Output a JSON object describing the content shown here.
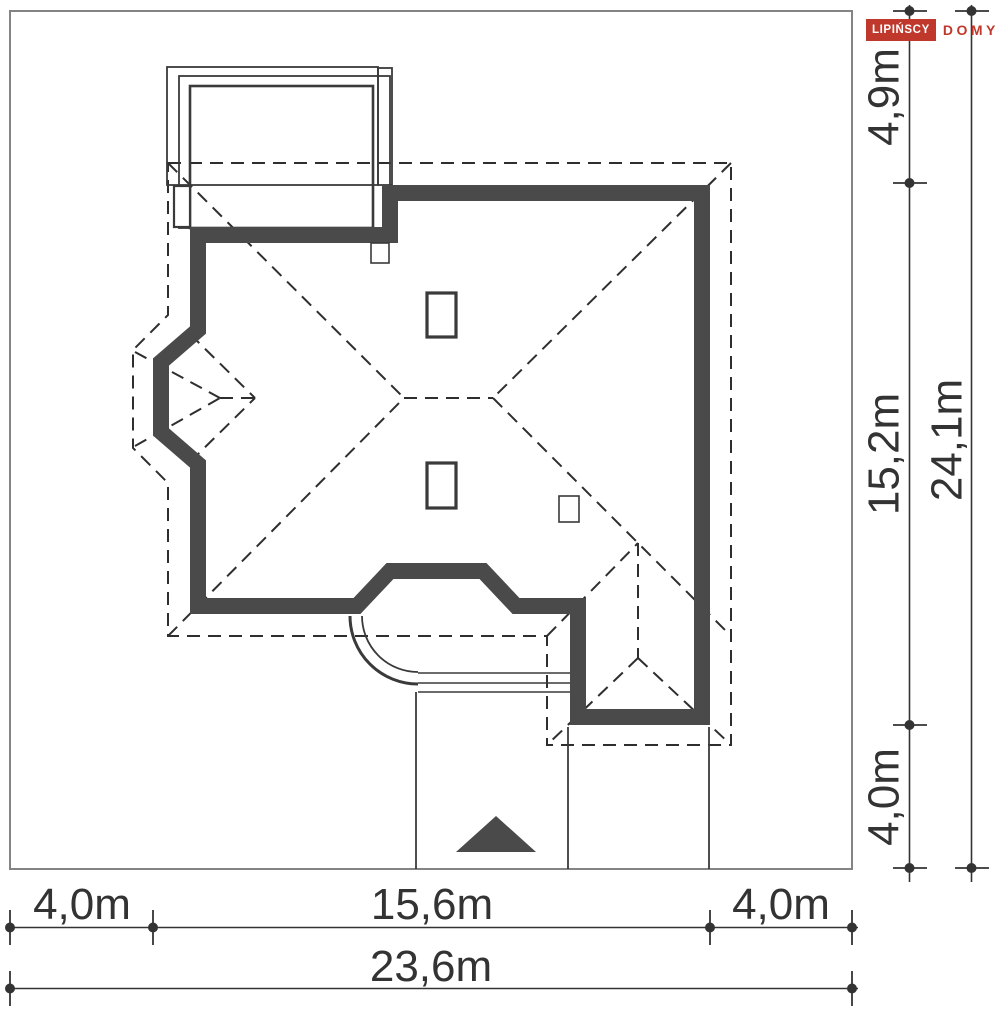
{
  "logo": {
    "brand": "LIPIŃSCY",
    "sub": "DOMY"
  },
  "plot": {
    "dimensions": {
      "right_top": "4,9m",
      "right_middle": "15,2m",
      "right_bottom": "4,0m",
      "right_total": "24,1m",
      "bottom_left": "4,0m",
      "bottom_center": "15,6m",
      "bottom_right": "4,0m",
      "bottom_total": "23,6m"
    }
  },
  "colors": {
    "background": "#ffffff",
    "wall": "#4a4a4a",
    "line": "#2e2e2e",
    "thin": "#3a3a3a",
    "text": "#333333",
    "plot_border": "#848484",
    "logo_red": "#c0382b"
  }
}
